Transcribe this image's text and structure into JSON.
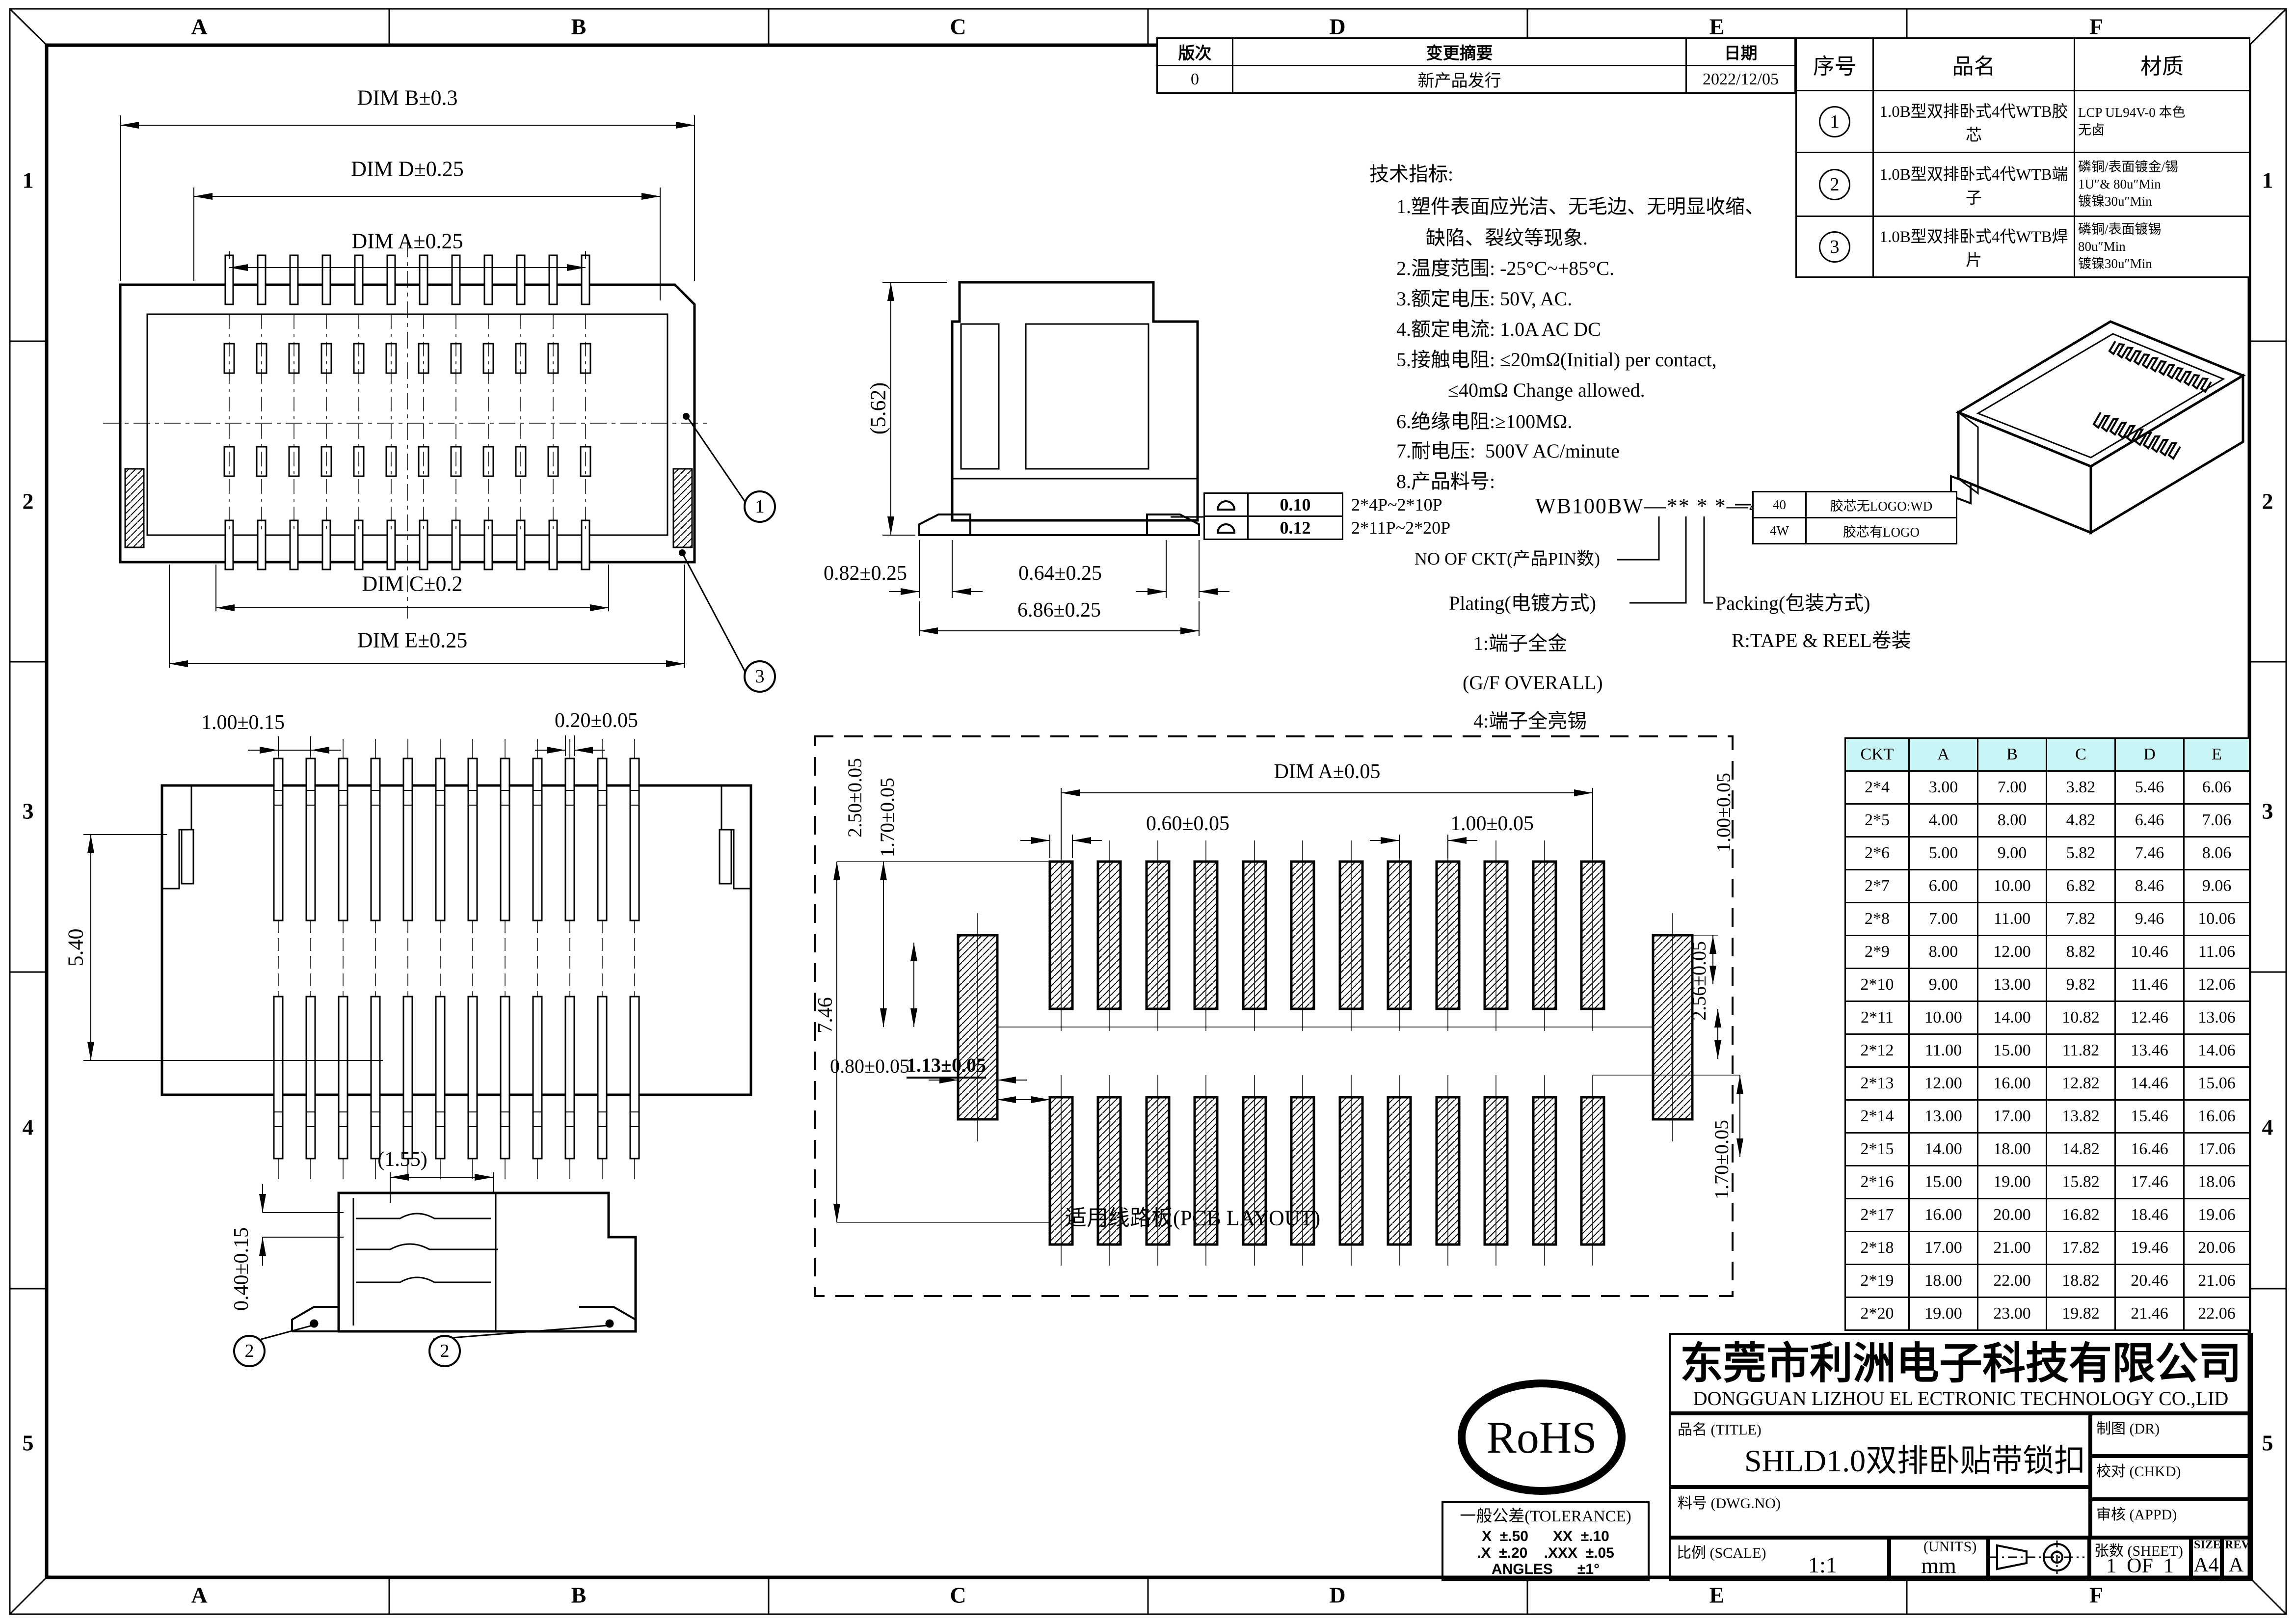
{
  "sheet": {
    "bg": "#ffffff",
    "line_color": "#000000",
    "table_header_bg": "#c8f6f6"
  },
  "border": {
    "top_letters": [
      "A",
      "B",
      "C",
      "D",
      "E",
      "F"
    ],
    "bottom_letters": [
      "A",
      "B",
      "C",
      "D",
      "E",
      "F"
    ],
    "left_numbers": [
      "1",
      "2",
      "3",
      "4",
      "5"
    ],
    "right_numbers": [
      "1",
      "2",
      "3",
      "4",
      "5"
    ]
  },
  "revision_table": {
    "headers": [
      "版次",
      "变更摘要",
      "日期"
    ],
    "rows": [
      [
        "0",
        "新产品发行",
        "2022/12/05"
      ]
    ]
  },
  "parts_table": {
    "headers": [
      "序号",
      "品名",
      "材质"
    ],
    "items": [
      {
        "num": "1",
        "name": "1.0B型双排卧式4代WTB胶芯",
        "material": "LCP UL94V-0 本色\n无卤"
      },
      {
        "num": "2",
        "name": "1.0B型双排卧式4代WTB端子",
        "material": "磷铜/表面镀金/锡\n1U″& 80u″Min\n镀镍30u″Min"
      },
      {
        "num": "3",
        "name": "1.0B型双排卧式4代WTB焊片",
        "material": "磷铜/表面镀锡\n80u″Min\n镀镍30u″Min"
      }
    ]
  },
  "tech_specs": {
    "title": "技术指标:",
    "lines": [
      "1.塑件表面应光洁、无毛边、无明显收缩、",
      "缺陷、裂纹等现象.",
      "2.温度范围: -25°C~+85°C.",
      "3.额定电压: 50V, AC.",
      "4.额定电流: 1.0A AC DC",
      "5.接触电阻: ≤20mΩ(Initial) per contact,",
      "≤40mΩ Change allowed.",
      "6.绝缘电阻:≥100MΩ.",
      "7.耐电压:  500V AC/minute",
      "8.产品料号:"
    ]
  },
  "part_number": {
    "code": "WB100BW—** * *—4*",
    "ckt_label": "NO OF CKT(产品PIN数)",
    "plating_label": "Plating(电镀方式)",
    "plating_opt1": "1:端子全金",
    "plating_opt1b": "(G/F OVERALL)",
    "plating_opt4": "4:端子全亮锡",
    "packing_label": "Packing(包装方式)",
    "packing_opt": "R:TAPE & REEL卷装",
    "logo_table": [
      [
        "40",
        "胶芯无LOGO:WD"
      ],
      [
        "4W",
        "胶芯有LOGO"
      ]
    ]
  },
  "coplanarity": {
    "rows": [
      {
        "value": "0.10",
        "range": "2*4P~2*10P"
      },
      {
        "value": "0.12",
        "range": "2*11P~2*20P"
      }
    ]
  },
  "dims": {
    "top_view": {
      "b": "DIM B±0.3",
      "d": "DIM D±0.25",
      "a": "DIM A±0.25",
      "c": "DIM C±0.2",
      "e": "DIM E±0.25",
      "balloon1": "1",
      "balloon3": "3"
    },
    "side_view": {
      "h": "(5.62)",
      "d1": "0.82±0.25",
      "d2": "0.64±0.25",
      "d3": "6.86±0.25"
    },
    "bottom_view": {
      "pitch": "1.00±0.15",
      "pin": "0.20±0.05",
      "h": "5.40"
    },
    "section_view": {
      "d1": "(1.55)",
      "d2": "0.40±0.15",
      "balloon2": "2"
    },
    "pcb": {
      "a": "DIM A±0.05",
      "pad": "0.60±0.05",
      "pitch": "1.00±0.05",
      "v1": "2.50±0.05",
      "v2": "1.70±0.05",
      "v3": "1.00±0.05",
      "v4": "2.56±0.05",
      "v5": "7.46",
      "h1": "0.80±0.05",
      "h2": "1.13±0.05",
      "v6": "1.70±0.05",
      "caption": "适用线路板(PCB LAYOUT)"
    }
  },
  "ckt_table": {
    "headers": [
      "CKT",
      "A",
      "B",
      "C",
      "D",
      "E"
    ],
    "rows": [
      [
        "2*4",
        "3.00",
        "7.00",
        "3.82",
        "5.46",
        "6.06"
      ],
      [
        "2*5",
        "4.00",
        "8.00",
        "4.82",
        "6.46",
        "7.06"
      ],
      [
        "2*6",
        "5.00",
        "9.00",
        "5.82",
        "7.46",
        "8.06"
      ],
      [
        "2*7",
        "6.00",
        "10.00",
        "6.82",
        "8.46",
        "9.06"
      ],
      [
        "2*8",
        "7.00",
        "11.00",
        "7.82",
        "9.46",
        "10.06"
      ],
      [
        "2*9",
        "8.00",
        "12.00",
        "8.82",
        "10.46",
        "11.06"
      ],
      [
        "2*10",
        "9.00",
        "13.00",
        "9.82",
        "11.46",
        "12.06"
      ],
      [
        "2*11",
        "10.00",
        "14.00",
        "10.82",
        "12.46",
        "13.06"
      ],
      [
        "2*12",
        "11.00",
        "15.00",
        "11.82",
        "13.46",
        "14.06"
      ],
      [
        "2*13",
        "12.00",
        "16.00",
        "12.82",
        "14.46",
        "15.06"
      ],
      [
        "2*14",
        "13.00",
        "17.00",
        "13.82",
        "15.46",
        "16.06"
      ],
      [
        "2*15",
        "14.00",
        "18.00",
        "14.82",
        "16.46",
        "17.06"
      ],
      [
        "2*16",
        "15.00",
        "19.00",
        "15.82",
        "17.46",
        "18.06"
      ],
      [
        "2*17",
        "16.00",
        "20.00",
        "16.82",
        "18.46",
        "19.06"
      ],
      [
        "2*18",
        "17.00",
        "21.00",
        "17.82",
        "19.46",
        "20.06"
      ],
      [
        "2*19",
        "18.00",
        "22.00",
        "18.82",
        "20.46",
        "21.06"
      ],
      [
        "2*20",
        "19.00",
        "23.00",
        "19.82",
        "21.46",
        "22.06"
      ]
    ]
  },
  "title_block": {
    "company_cn": "东莞市利洲电子科技有限公司",
    "company_en": "DONGGUAN LIZHOU EL ECTRONIC TECHNOLOGY CO.,LID",
    "title_label": "品名 (TITLE)",
    "title_value": "SHLD1.0双排卧贴带锁扣",
    "dwg_label": "料号 (DWG.NO)",
    "dr_label": "制图 (DR)",
    "chkd_label": "校对 (CHKD)",
    "appd_label": "审核 (APPD)",
    "scale_label": "比例 (SCALE)",
    "scale_value": "1:1",
    "units_label": "(UNITS)",
    "units_value": "mm",
    "sheet_label": "张数 (SHEET)",
    "sheet_value": "1  OF  1",
    "size_label": "SIZE",
    "size_value": "A4",
    "rev_label": "REV",
    "rev_value": "A"
  },
  "tolerance_block": {
    "title": "一般公差(TOLERANCE)",
    "line1": "X  ±.50      XX  ±.10",
    "line2": ".X  ±.20    .XXX  ±.05",
    "line3": "ANGLES      ±1°"
  },
  "rohs": {
    "label": "RoHS"
  }
}
